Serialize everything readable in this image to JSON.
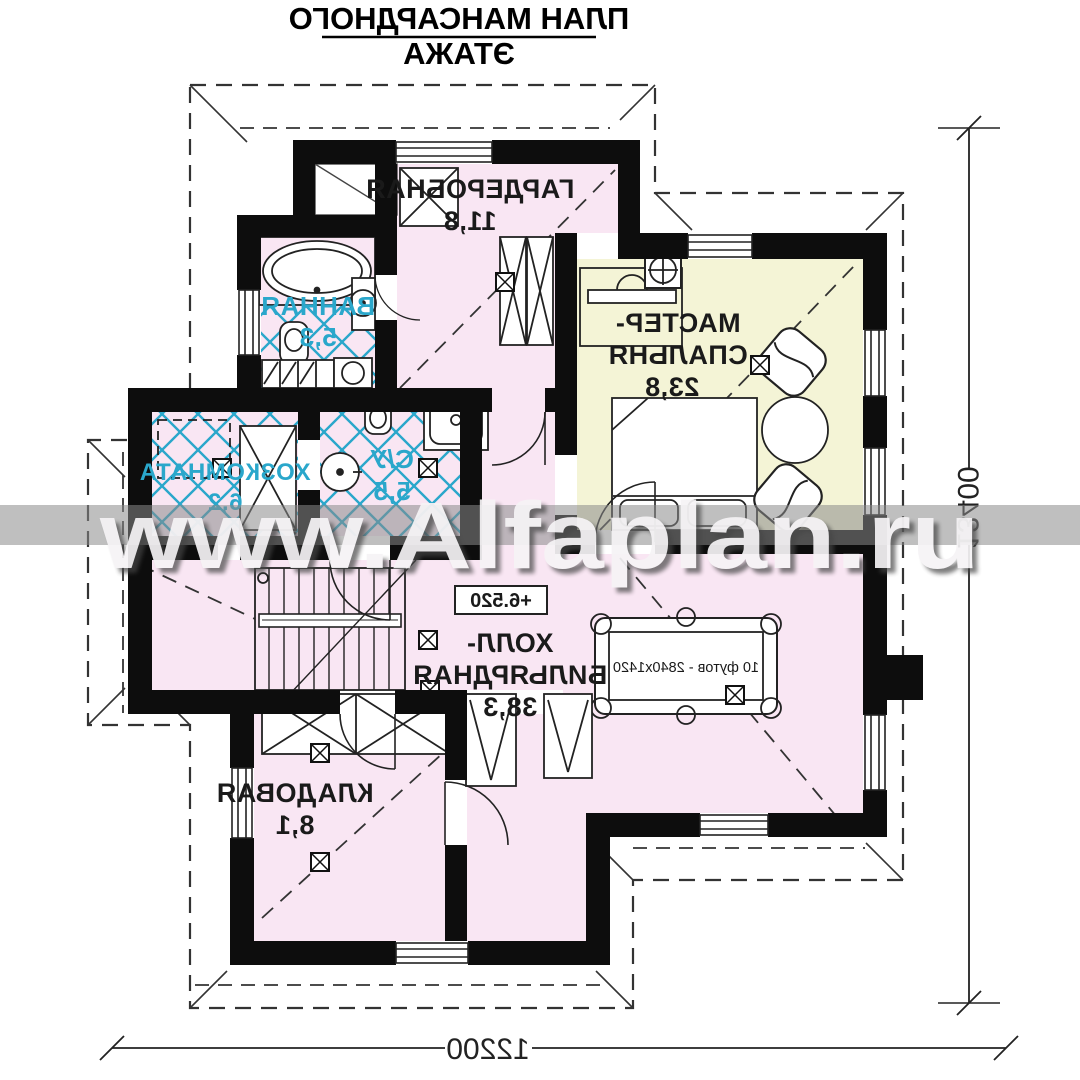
{
  "title": {
    "line1": "ПЛАН МАНСАРДНОГО",
    "line2": "ЭТАЖА"
  },
  "watermark": "www.Alfaplan.ru",
  "rooms": {
    "wardrobe": {
      "name": "ГАРДЕРОБНАЯ",
      "area": "11,8"
    },
    "bathroom": {
      "name": "ВАННАЯ",
      "area": "5,3"
    },
    "master_bedroom": {
      "name_line1": "МАСТЕР-",
      "name_line2": "СПАЛЬНЯ",
      "area": "23,8"
    },
    "utility": {
      "name": "ХОЗКОМНАТА",
      "area": "6,2"
    },
    "wc": {
      "name": "С/У",
      "area": "5,5"
    },
    "hall_billiard": {
      "name_line1": "ХОЛЛ-",
      "name_line2": "БИЛЬЯРДНАЯ",
      "area": "38,3"
    },
    "storage": {
      "name": "КЛАДОВАЯ",
      "area": "8,1"
    }
  },
  "annotations": {
    "elevation": "+6.520",
    "billiard_table_size": "10 футов - 2840х1420"
  },
  "dimensions": {
    "width": "12200",
    "height": "13400"
  },
  "colors": {
    "room_pink": "#f9e6f3",
    "room_yellow": "#f4f4d6",
    "tile_line": "#2aa7cb",
    "wall": "#0d0d0d",
    "watermark_band": "#8a8a8a"
  }
}
